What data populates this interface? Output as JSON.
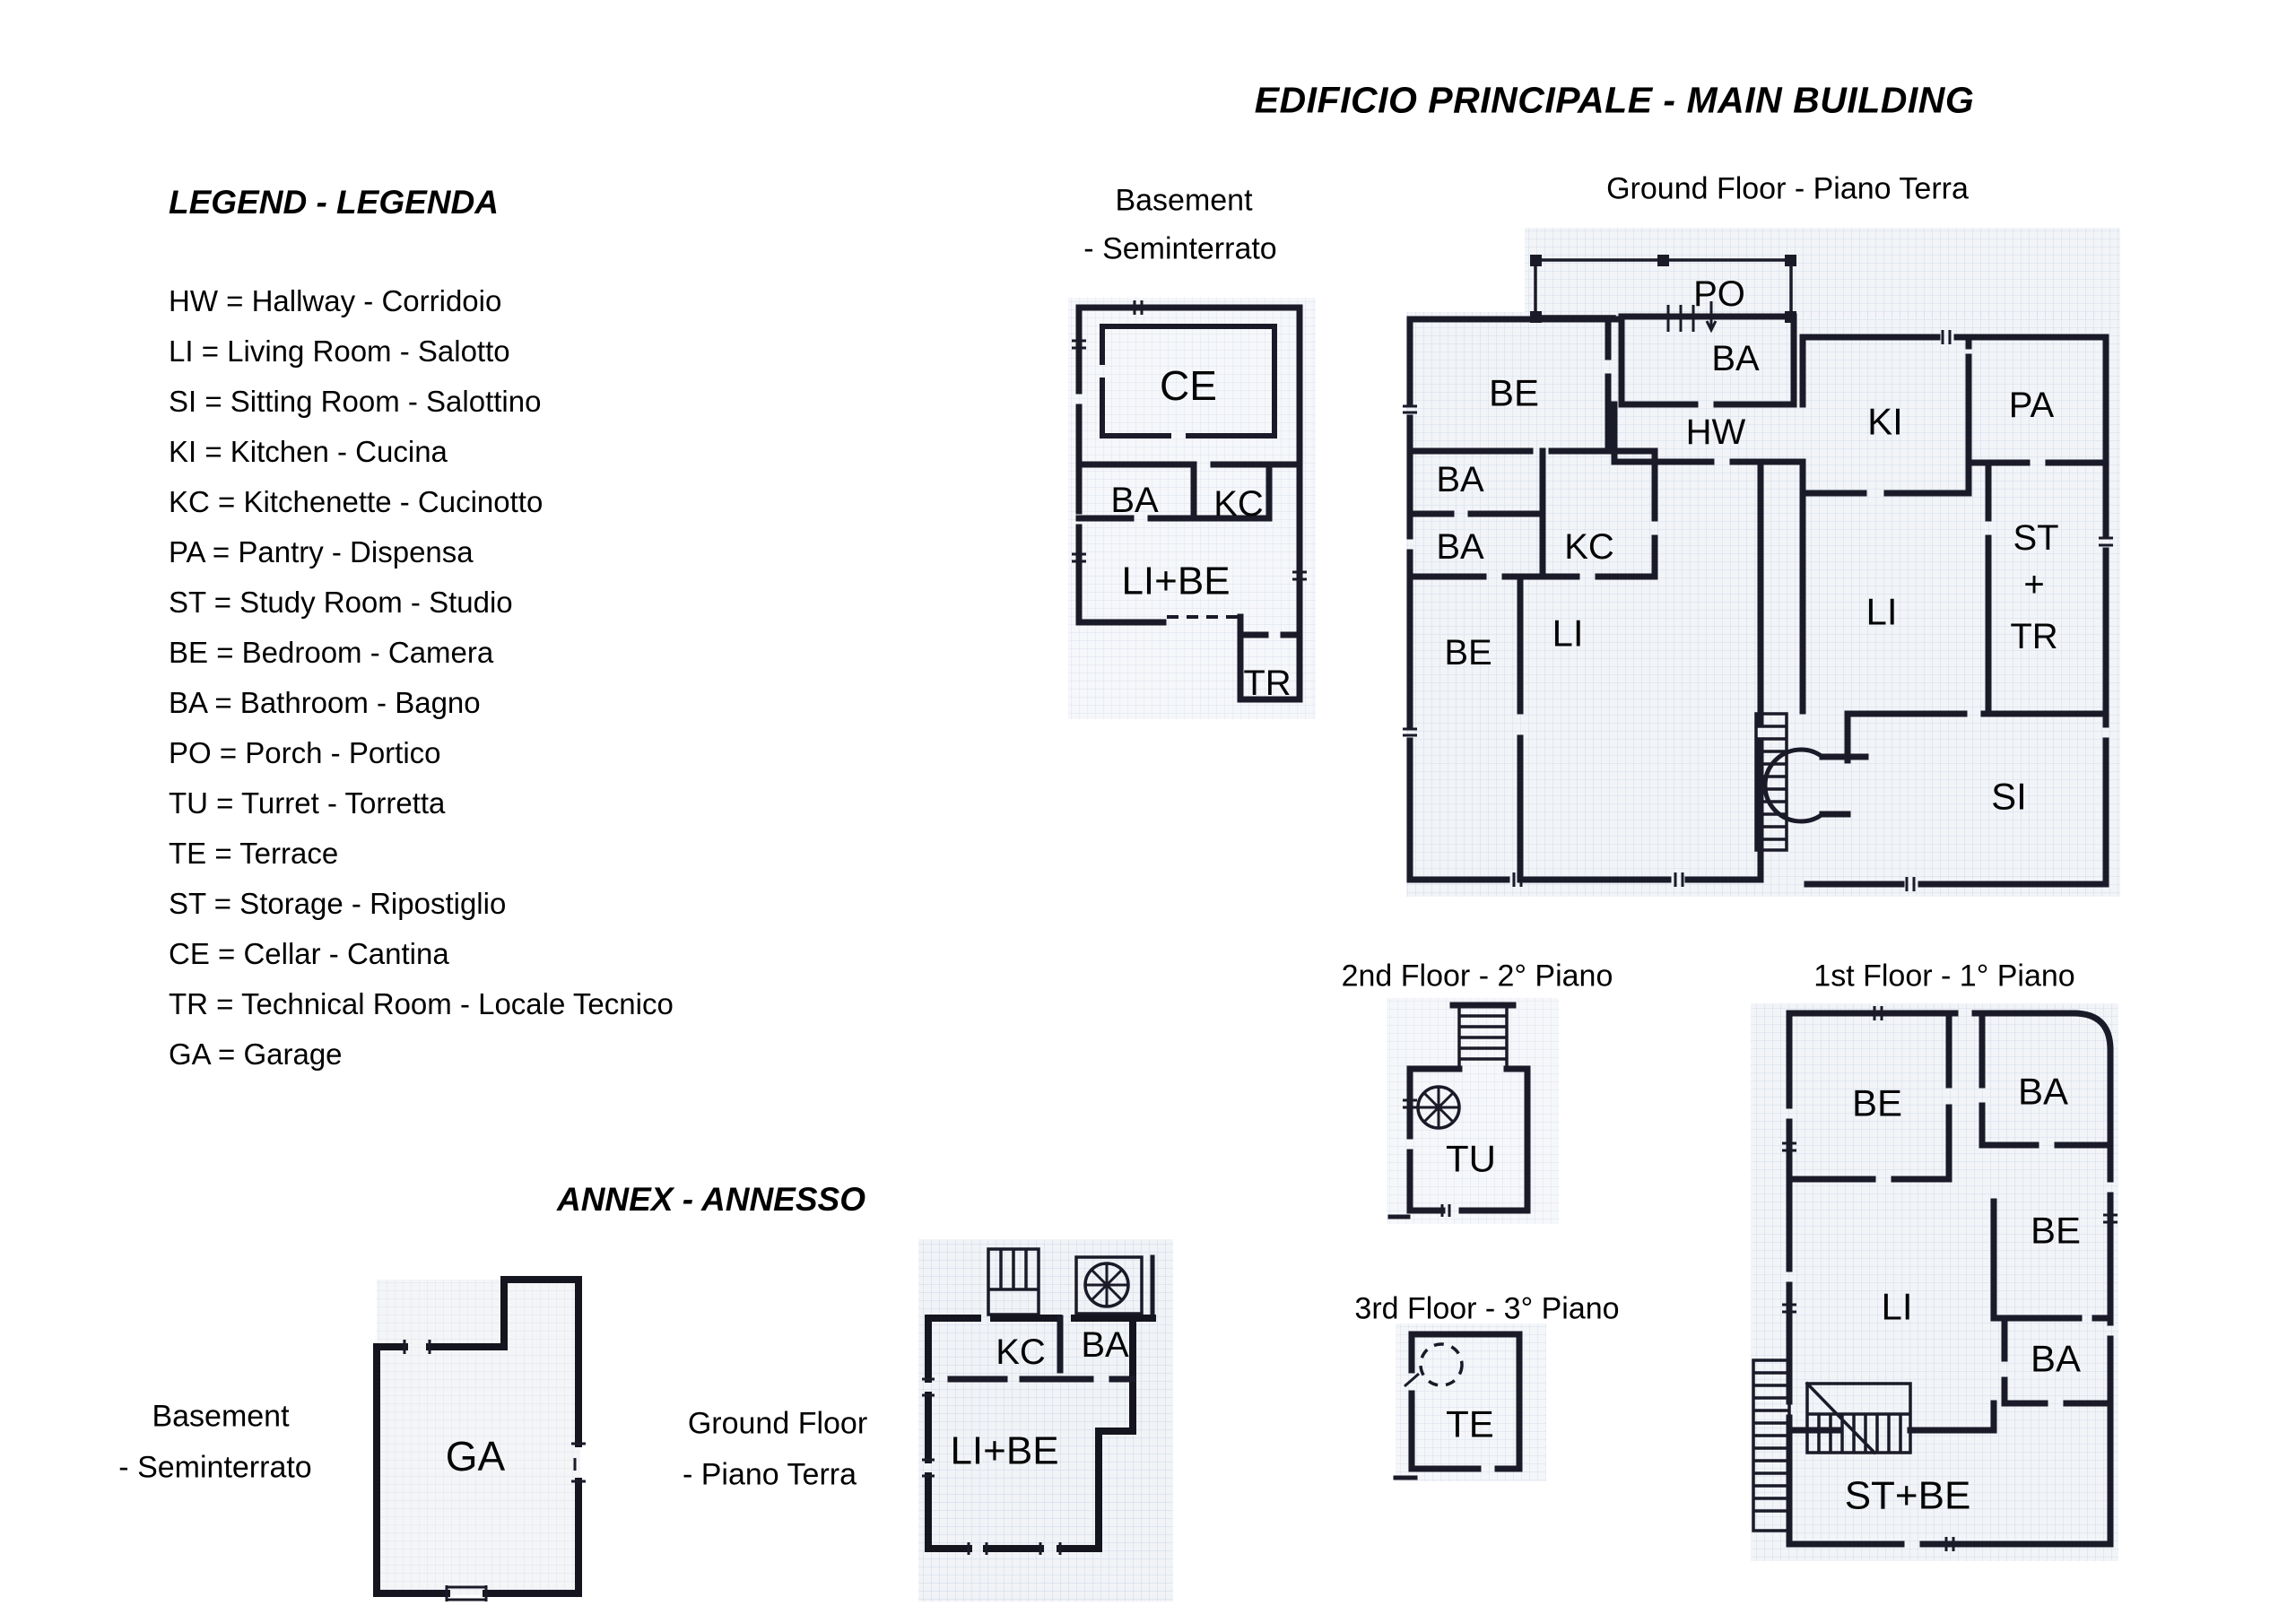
{
  "main_building": {
    "title": "EDIFICIO PRINCIPALE - MAIN BUILDING",
    "floors": {
      "basement": {
        "label_line1": "Basement",
        "label_line2": "- Seminterrato",
        "rooms": {
          "ce": "CE",
          "ba": "BA",
          "kc": "KC",
          "li_be": "LI+BE",
          "tr": "TR"
        }
      },
      "ground": {
        "label": "Ground Floor - Piano Terra",
        "rooms": {
          "po": "PO",
          "ba_top": "BA",
          "hw": "HW",
          "be_top": "BE",
          "ba_left_upper": "BA",
          "ba_left_lower": "BA",
          "kc": "KC",
          "li_left": "LI",
          "be_bottom": "BE",
          "ki": "KI",
          "pa": "PA",
          "st": "ST",
          "plus": "+",
          "tr": "TR",
          "li_right": "LI",
          "si": "SI"
        }
      },
      "first": {
        "label": "1st Floor - 1° Piano",
        "rooms": {
          "be_top": "BE",
          "ba_top": "BA",
          "be_right": "BE",
          "li": "LI",
          "ba_right": "BA",
          "st_be": "ST+BE"
        }
      },
      "second": {
        "label": "2nd Floor - 2° Piano",
        "rooms": {
          "tu": "TU"
        }
      },
      "third": {
        "label": "3rd Floor - 3° Piano",
        "rooms": {
          "te": "TE"
        }
      }
    }
  },
  "annex": {
    "title": "ANNEX - ANNESSO",
    "floors": {
      "basement": {
        "label_line1": "Basement",
        "label_line2": "- Seminterrato",
        "rooms": {
          "ga": "GA"
        }
      },
      "ground": {
        "label_line1": "Ground Floor",
        "label_line2": "- Piano Terra",
        "rooms": {
          "kc": "KC",
          "ba": "BA",
          "li_be": "LI+BE"
        }
      }
    }
  },
  "legend": {
    "title": "LEGEND - LEGENDA",
    "items": [
      "HW = Hallway - Corridoio",
      "LI = Living Room - Salotto",
      "SI = Sitting Room - Salottino",
      "KI = Kitchen - Cucina",
      "KC = Kitchenette - Cucinotto",
      "PA = Pantry - Dispensa",
      "ST = Study Room - Studio",
      "BE = Bedroom - Camera",
      "BA = Bathroom - Bagno",
      "PO = Porch - Portico",
      "TU = Turret - Torretta",
      "TE = Terrace",
      "ST = Storage - Ripostiglio",
      "CE = Cellar - Cantina",
      "TR = Technical Room - Locale Tecnico",
      "GA = Garage"
    ]
  },
  "colors": {
    "wall": "#1a1a28",
    "grid_line": "#a9bcd9",
    "paper": "#f2f4f8",
    "text": "#000000"
  }
}
